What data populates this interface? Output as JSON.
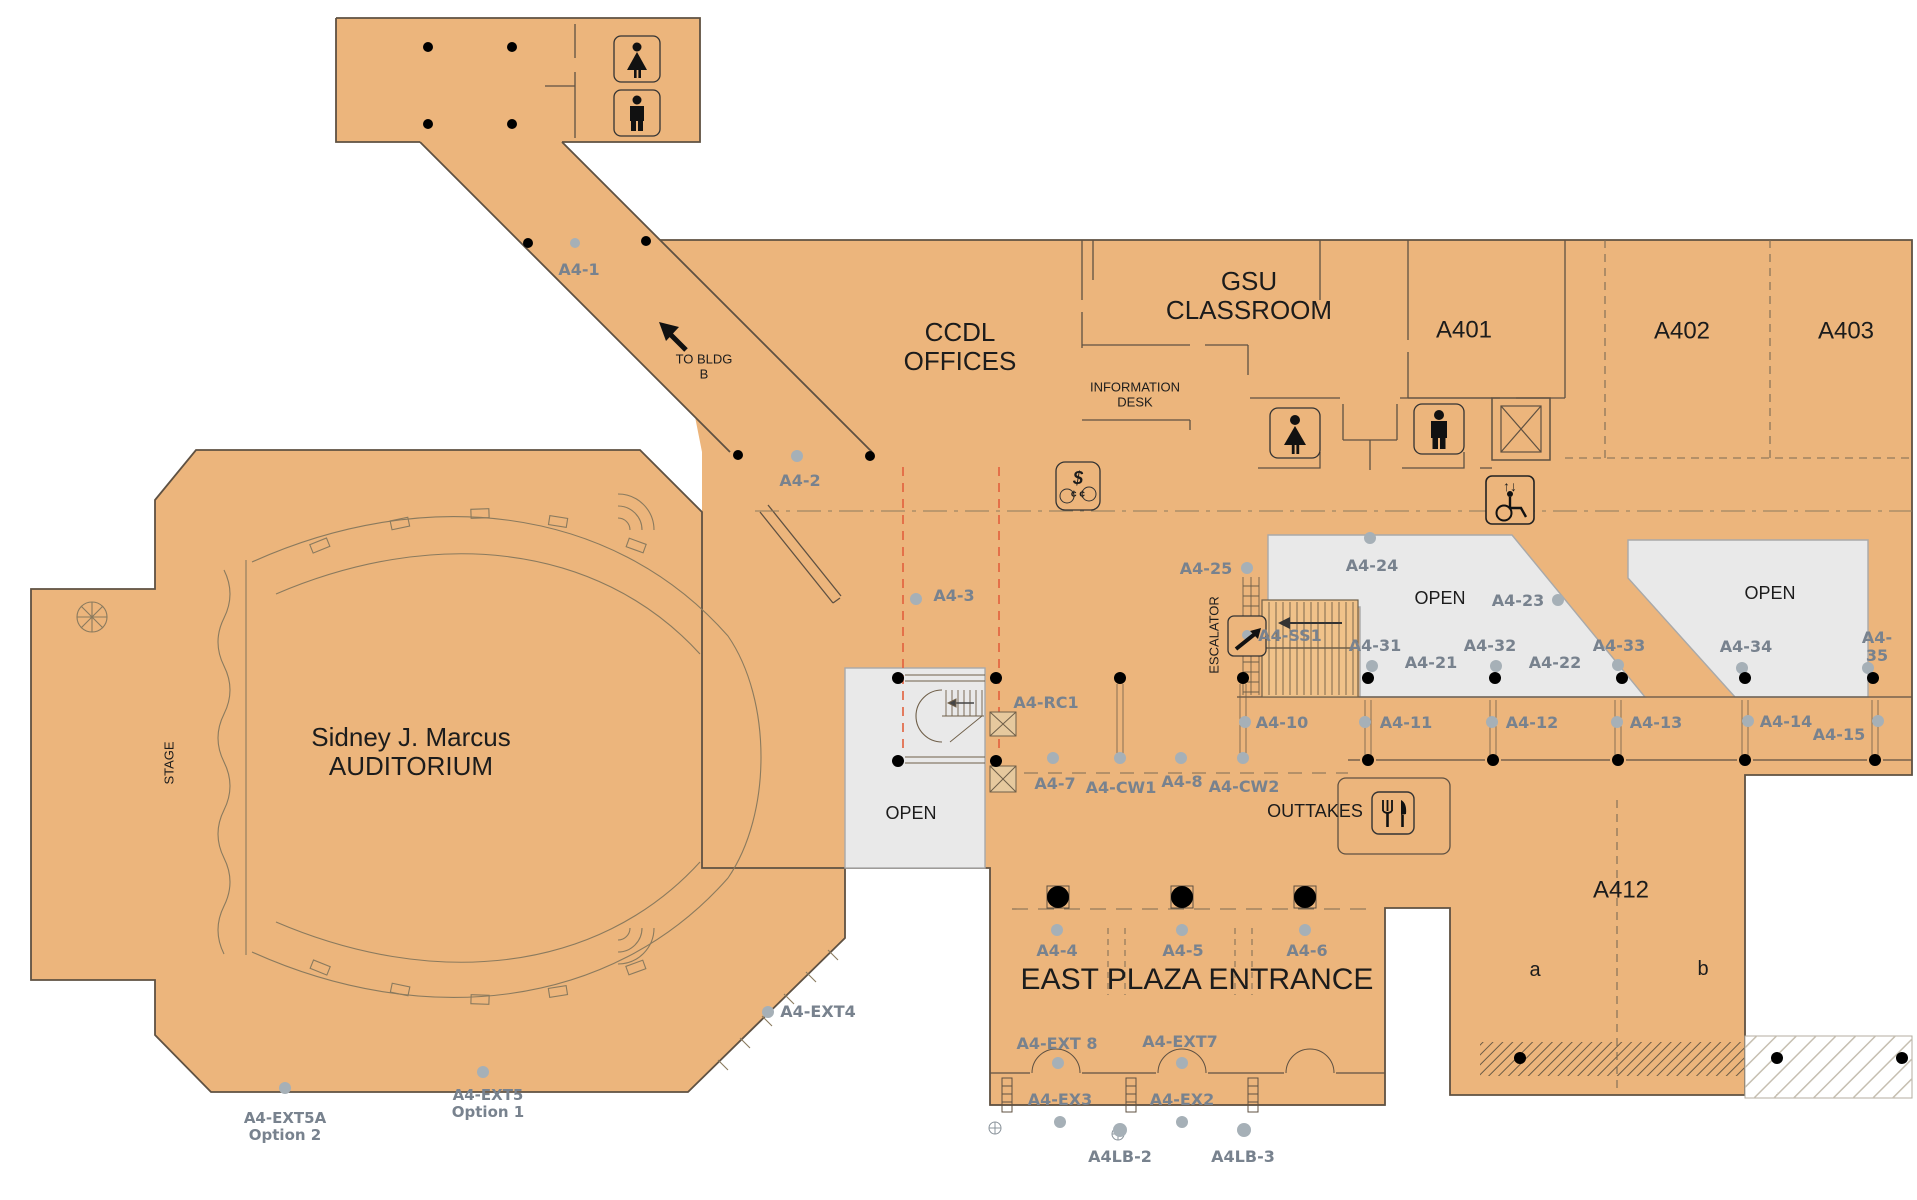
{
  "title": "Building A — Level 4 floor plan",
  "colors": {
    "floor_tan": "#ecb57c",
    "stair_tan": "#f0c28a",
    "wall": "#5f5142",
    "open_gray": "#e9e9e9",
    "label_gray": "#78828e",
    "label_black": "#1c1c1c",
    "fire_dash_red": "#e2603d",
    "dot_gray": "#a6b0b7",
    "dot_black": "#000000"
  },
  "areas": {
    "auditorium": "Sidney J. Marcus\nAUDITORIUM",
    "stage": "STAGE",
    "ccdl_offices": "CCDL\nOFFICES",
    "gsu_classroom": "GSU\nCLASSROOM",
    "information_desk": "INFORMATION\nDESK",
    "to_bldg_b": "TO BLDG\nB",
    "open": "OPEN",
    "escalator": "ESCALATOR",
    "outtakes": "OUTTAKES",
    "east_plaza_entrance": "EAST PLAZA ENTRANCE",
    "a401": "A401",
    "a402": "A402",
    "a403": "A403",
    "a412": "A412",
    "a412_a": "a",
    "a412_b": "b"
  },
  "door_ids": {
    "a4_1": "A4-1",
    "a4_2": "A4-2",
    "a4_3": "A4-3",
    "a4_4": "A4-4",
    "a4_5": "A4-5",
    "a4_6": "A4-6",
    "a4_7": "A4-7",
    "a4_8": "A4-8",
    "a4_10": "A4-10",
    "a4_11": "A4-11",
    "a4_12": "A4-12",
    "a4_13": "A4-13",
    "a4_14": "A4-14",
    "a4_15": "A4-15",
    "a4_21": "A4-21",
    "a4_22": "A4-22",
    "a4_23": "A4-23",
    "a4_24": "A4-24",
    "a4_25": "A4-25",
    "a4_31": "A4-31",
    "a4_32": "A4-32",
    "a4_33": "A4-33",
    "a4_34": "A4-34",
    "a4_35": "A4-35",
    "a4_ss1": "A4-SS1",
    "a4_rc1": "A4-RC1",
    "a4_cw1": "A4-CW1",
    "a4_cw2": "A4-CW2"
  },
  "exits": {
    "a4_ext4": "A4-EXT4",
    "a4_ext5": "A4-EXT5\nOption 1",
    "a4_ext5a": "A4-EXT5A\nOption 2",
    "a4_ext7": "A4-EXT7",
    "a4_ext8": "A4-EXT 8",
    "a4_ex2": "A4-EX2",
    "a4_ex3": "A4-EX3",
    "a4lb_2": "A4LB-2",
    "a4lb_3": "A4LB-3"
  },
  "icons": {
    "money_dollar": "$",
    "money_cents": "¢ ¢",
    "lift_arrows": "↑↓"
  }
}
